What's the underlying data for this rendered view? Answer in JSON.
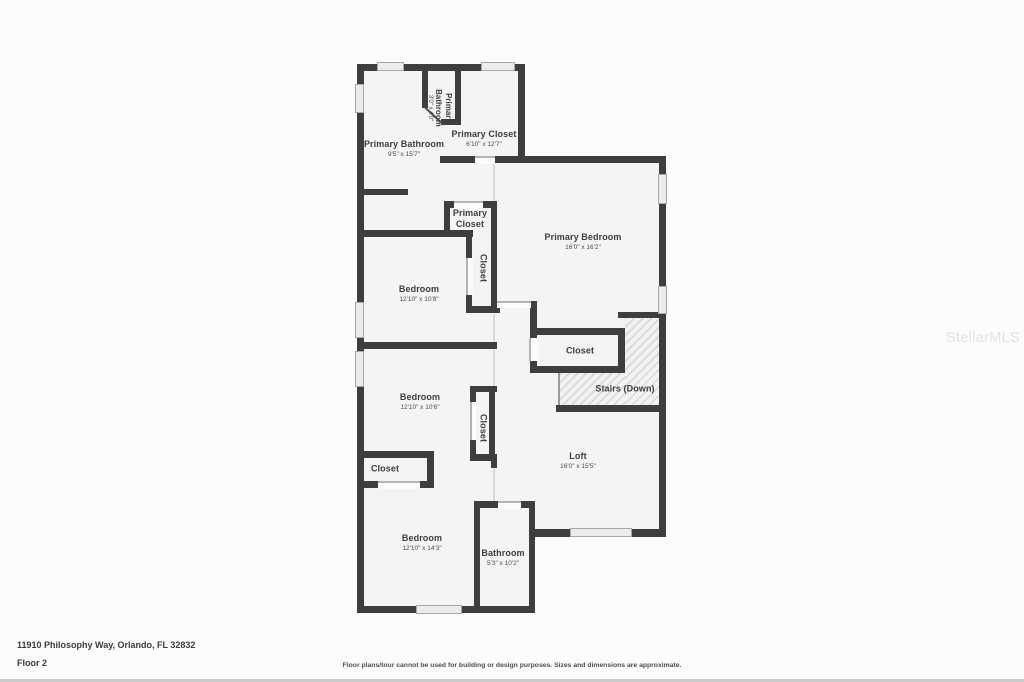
{
  "footer": {
    "address": "11910 Philosophy Way, Orlando, FL 32832",
    "floor": "Floor 2",
    "disclaimer": "Floor plans/tour cannot be used for building or design purposes. Sizes and dimensions are approximate."
  },
  "watermark": "StellarMLS",
  "colors": {
    "wall": "#3e3e3e",
    "floor_fill": "#f4f4f4",
    "page_bg": "#fcfcfc",
    "window_fill": "#ececec",
    "label_text": "#3d3d3d",
    "watermark_text": "#e3e3e3"
  },
  "plan": {
    "floor": [
      {
        "x": 357,
        "y": 64,
        "w": 168,
        "h": 99
      },
      {
        "x": 357,
        "y": 157,
        "w": 140,
        "h": 456
      },
      {
        "x": 495,
        "y": 157,
        "w": 171,
        "h": 380
      },
      {
        "x": 474,
        "y": 502,
        "w": 61,
        "h": 111
      }
    ],
    "stairs_hatch": [
      {
        "x": 625,
        "y": 318,
        "w": 35,
        "h": 88
      },
      {
        "x": 560,
        "y": 373,
        "w": 65,
        "h": 33
      }
    ],
    "stairs_edge": [
      {
        "x": 558,
        "y": 373,
        "w": 2,
        "h": 33
      }
    ],
    "walls": [
      {
        "x": 357,
        "y": 64,
        "w": 168,
        "h": 7
      },
      {
        "x": 357,
        "y": 64,
        "w": 7,
        "h": 549
      },
      {
        "x": 518,
        "y": 64,
        "w": 7,
        "h": 99
      },
      {
        "x": 422,
        "y": 64,
        "w": 6,
        "h": 44
      },
      {
        "x": 455,
        "y": 64,
        "w": 6,
        "h": 60
      },
      {
        "x": 441,
        "y": 119,
        "w": 20,
        "h": 6
      },
      {
        "x": 440,
        "y": 156,
        "w": 35,
        "h": 7
      },
      {
        "x": 495,
        "y": 156,
        "w": 171,
        "h": 7
      },
      {
        "x": 659,
        "y": 156,
        "w": 7,
        "h": 381
      },
      {
        "x": 357,
        "y": 189,
        "w": 51,
        "h": 6
      },
      {
        "x": 444,
        "y": 201,
        "w": 11,
        "h": 7
      },
      {
        "x": 482,
        "y": 201,
        "w": 15,
        "h": 7
      },
      {
        "x": 444,
        "y": 201,
        "w": 6,
        "h": 36
      },
      {
        "x": 491,
        "y": 201,
        "w": 6,
        "h": 112
      },
      {
        "x": 357,
        "y": 230,
        "w": 116,
        "h": 7
      },
      {
        "x": 466,
        "y": 236,
        "w": 6,
        "h": 23
      },
      {
        "x": 466,
        "y": 294,
        "w": 6,
        "h": 19
      },
      {
        "x": 466,
        "y": 306,
        "w": 34,
        "h": 7
      },
      {
        "x": 357,
        "y": 342,
        "w": 140,
        "h": 7
      },
      {
        "x": 470,
        "y": 386,
        "w": 27,
        "h": 6
      },
      {
        "x": 470,
        "y": 386,
        "w": 6,
        "h": 17
      },
      {
        "x": 470,
        "y": 439,
        "w": 6,
        "h": 22
      },
      {
        "x": 489,
        "y": 386,
        "w": 6,
        "h": 75
      },
      {
        "x": 470,
        "y": 454,
        "w": 27,
        "h": 7
      },
      {
        "x": 530,
        "y": 301,
        "w": 7,
        "h": 72
      },
      {
        "x": 530,
        "y": 328,
        "w": 95,
        "h": 7
      },
      {
        "x": 530,
        "y": 366,
        "w": 95,
        "h": 7
      },
      {
        "x": 618,
        "y": 328,
        "w": 7,
        "h": 45
      },
      {
        "x": 618,
        "y": 312,
        "w": 48,
        "h": 6
      },
      {
        "x": 556,
        "y": 405,
        "w": 110,
        "h": 7
      },
      {
        "x": 529,
        "y": 529,
        "w": 137,
        "h": 8
      },
      {
        "x": 474,
        "y": 501,
        "w": 6,
        "h": 112
      },
      {
        "x": 474,
        "y": 501,
        "w": 25,
        "h": 7
      },
      {
        "x": 520,
        "y": 501,
        "w": 15,
        "h": 7
      },
      {
        "x": 529,
        "y": 501,
        "w": 6,
        "h": 112
      },
      {
        "x": 357,
        "y": 606,
        "w": 178,
        "h": 7
      },
      {
        "x": 357,
        "y": 451,
        "w": 77,
        "h": 7
      },
      {
        "x": 427,
        "y": 451,
        "w": 7,
        "h": 37
      },
      {
        "x": 357,
        "y": 481,
        "w": 22,
        "h": 7
      },
      {
        "x": 419,
        "y": 481,
        "w": 15,
        "h": 7
      },
      {
        "x": 491,
        "y": 455,
        "w": 6,
        "h": 13
      }
    ],
    "windows": [
      {
        "x": 377,
        "y": 62,
        "w": 27,
        "h": 9
      },
      {
        "x": 481,
        "y": 62,
        "w": 34,
        "h": 9
      },
      {
        "x": 355,
        "y": 84,
        "w": 9,
        "h": 29
      },
      {
        "x": 355,
        "y": 302,
        "w": 9,
        "h": 36
      },
      {
        "x": 355,
        "y": 351,
        "w": 9,
        "h": 36
      },
      {
        "x": 658,
        "y": 174,
        "w": 9,
        "h": 30
      },
      {
        "x": 658,
        "y": 286,
        "w": 9,
        "h": 28
      },
      {
        "x": 570,
        "y": 528,
        "w": 62,
        "h": 9
      },
      {
        "x": 416,
        "y": 605,
        "w": 46,
        "h": 9
      }
    ],
    "doors": [
      {
        "x": 475,
        "y": 156,
        "w": 20,
        "h": 8,
        "side": "top"
      },
      {
        "x": 454,
        "y": 201,
        "w": 29,
        "h": 8,
        "side": "top"
      },
      {
        "x": 466,
        "y": 258,
        "w": 7,
        "h": 37,
        "side": "left"
      },
      {
        "x": 470,
        "y": 402,
        "w": 6,
        "h": 38,
        "side": "left"
      },
      {
        "x": 529,
        "y": 338,
        "w": 9,
        "h": 23,
        "side": "left"
      },
      {
        "x": 378,
        "y": 481,
        "w": 42,
        "h": 8,
        "side": "top"
      },
      {
        "x": 498,
        "y": 501,
        "w": 23,
        "h": 8,
        "side": "top"
      },
      {
        "x": 497,
        "y": 301,
        "w": 34,
        "h": 7,
        "side": "top"
      }
    ],
    "openings": [
      {
        "x": 493,
        "y": 164,
        "w": 2,
        "h": 37
      },
      {
        "x": 493,
        "y": 314,
        "w": 2,
        "h": 28
      },
      {
        "x": 493,
        "y": 350,
        "w": 2,
        "h": 36
      },
      {
        "x": 493,
        "y": 469,
        "w": 2,
        "h": 32
      }
    ],
    "door_leaves": [
      {
        "x": 426,
        "y": 107,
        "len": 25,
        "angle": 43
      }
    ],
    "rooms": [
      {
        "id": "primary-bathroom-wc",
        "name": "Primary Bathroom",
        "dims": "3'0\" x 4'0\"",
        "cx": 439,
        "cy": 108,
        "vertical": true,
        "narrow": true,
        "small": true
      },
      {
        "id": "primary-bathroom",
        "name": "Primary Bathroom",
        "dims": "9'5\" x 15'7\"",
        "cx": 404,
        "cy": 149
      },
      {
        "id": "primary-closet-upper",
        "name": "Primary Closet",
        "dims": "6'10\" x 12'7\"",
        "cx": 484,
        "cy": 139
      },
      {
        "id": "primary-bedroom",
        "name": "Primary Bedroom",
        "dims": "16'0\" x 16'2\"",
        "cx": 583,
        "cy": 242
      },
      {
        "id": "primary-closet-hall",
        "name": "Primary Closet",
        "cx": 470,
        "cy": 219,
        "narrow": true
      },
      {
        "id": "closet-bedroom-1",
        "name": "Closet",
        "cx": 483,
        "cy": 268,
        "vertical": true
      },
      {
        "id": "bedroom-1",
        "name": "Bedroom",
        "dims": "12'10\" x 10'8\"",
        "cx": 419,
        "cy": 294
      },
      {
        "id": "closet-stairs",
        "name": "Closet",
        "cx": 580,
        "cy": 351
      },
      {
        "id": "stairs-down",
        "name": "Stairs (Down)",
        "cx": 625,
        "cy": 389
      },
      {
        "id": "bedroom-2",
        "name": "Bedroom",
        "dims": "12'10\" x 10'6\"",
        "cx": 420,
        "cy": 402
      },
      {
        "id": "closet-bedroom-2",
        "name": "Closet",
        "cx": 483,
        "cy": 428,
        "vertical": true
      },
      {
        "id": "closet-bedroom-3",
        "name": "Closet",
        "cx": 385,
        "cy": 469
      },
      {
        "id": "loft",
        "name": "Loft",
        "dims": "16'0\" x 15'5\"",
        "cx": 578,
        "cy": 461
      },
      {
        "id": "bedroom-3",
        "name": "Bedroom",
        "dims": "12'10\" x 14'3\"",
        "cx": 422,
        "cy": 543
      },
      {
        "id": "bathroom",
        "name": "Bathroom",
        "dims": "5'3\" x 10'2\"",
        "cx": 503,
        "cy": 558
      }
    ]
  }
}
